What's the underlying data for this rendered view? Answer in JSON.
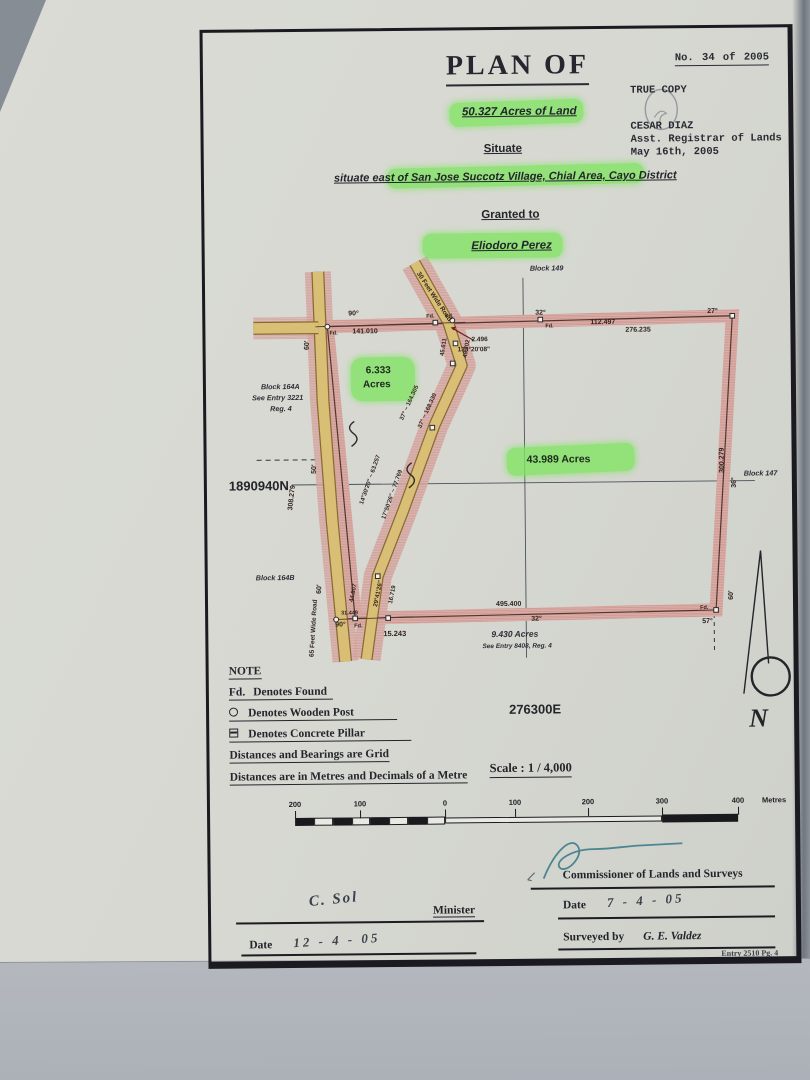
{
  "header": {
    "title": "PLAN OF",
    "doc_no": "No.  34  of  2005",
    "true_copy": "TRUE COPY",
    "registrar_name": "CESAR DIAZ",
    "registrar_title": "Asst. Registrar of Lands",
    "registrar_date": "May 16th, 2005",
    "acreage": "50.327 Acres of Land",
    "situate_label": "Situate",
    "situate_text": "situate east of San Jose Succotz Village, Chial Area, Cayo District",
    "granted_label": "Granted to",
    "grantee": "Eliodoro Perez"
  },
  "map": {
    "blocks": {
      "block149": "Block 149",
      "block147": "Block 147",
      "block164a_name": "Block 164A",
      "block164a_entry": "See Entry 3221",
      "block164a_reg": "Reg. 4",
      "block164b": "Block 164B"
    },
    "grid": {
      "northing": "1890940N",
      "easting": "276300E"
    },
    "parcels": {
      "acres_main": "43.989 Acres",
      "acres_6_value": "6.333",
      "acres_6_unit": "Acres",
      "acres_9": "9.430 Acres",
      "acres_9_entry": "See Entry 8408, Reg. 4"
    },
    "roads": {
      "road65": "65 Feet Wide Road",
      "road30": "30 Feet Wide Road"
    },
    "edges": {
      "top_left_angle": "90°",
      "top_dist1": "141.010",
      "top_dist2": "112.497",
      "top_mid_angle": "32°",
      "top_dist3": "276.235",
      "top_right_angle": "27°",
      "right_dist": "300.279",
      "right_angle": "36°",
      "br_width": "60'",
      "br_angle": "57°",
      "bottom_dist": "495.400",
      "bottom_angle": "32°",
      "bl_dist": "15.243",
      "bl_angle": "90°",
      "bl_dist2": "31.449",
      "left_dist": "308.279",
      "left_width": "50'",
      "road_width": "60'",
      "fd": "Fd."
    },
    "bearings": {
      "spur_dist": "2.496",
      "spur_bearing": "138°20'08\"",
      "b1": "37° ~ 164.305",
      "b2": "17°50'26\" ~ 77.769",
      "b3": "14°30'20\" ~ 63.257",
      "b4": "37° ~ 168.330",
      "b5": "44.807",
      "b6": "29°41'26\"",
      "b7": "16.719",
      "b8": "45.611",
      "b9": "49.702"
    },
    "north_label": "N"
  },
  "note": {
    "title": "NOTE",
    "fd_sym": "Fd.",
    "fd_text": "Denotes Found",
    "post_text": "Denotes Wooden Post",
    "pillar_text": "Denotes Concrete Pillar",
    "grid_text": "Distances and Bearings are Grid",
    "metric_text": "Distances are in Metres and Decimals of a Metre"
  },
  "scale": {
    "label": "Scale : 1 / 4,000",
    "ticks": [
      "200",
      "100",
      "0",
      "100",
      "200",
      "300",
      "400"
    ],
    "unit": "Metres"
  },
  "signatures": {
    "commissioner_label": "Commissioner of Lands and Surveys",
    "date_label": "Date",
    "commissioner_date": "7 - 4 - 05",
    "minister_label": "Minister",
    "minister_signature": "C. Sol",
    "minister_date": "12 - 4 - 05",
    "surveyed_label": "Surveyed by",
    "surveyor": "G. E. Valdez",
    "footer_note": "Entry 2510 Pg. 4"
  },
  "colors": {
    "highlight": "#82e464",
    "road_fill": "#d9bf76",
    "parcel_band": "#ddb0ab",
    "paper": "#d7d8d2",
    "frame_ink": "#1a1a20",
    "signature_blue": "#3e7d8c"
  }
}
